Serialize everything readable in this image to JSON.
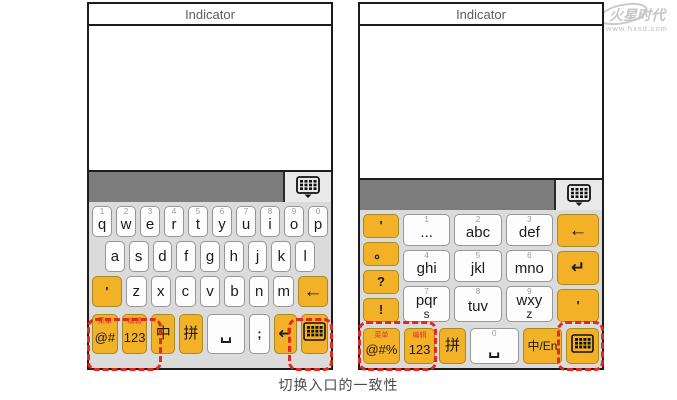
{
  "caption": "切换入口的一致性",
  "watermark": {
    "brand": "火星时代",
    "url": "www.hxsd.com"
  },
  "colors": {
    "key_yellow": "#F2B127",
    "highlight_red": "#E6281C",
    "toolbar_gray": "#7C7C7C",
    "keyboard_bg": "#DBDBDB",
    "hint_red": "#D93A26"
  },
  "left_phone": {
    "title": "Indicator",
    "toolbar_icon": "keyboard-panel-icon",
    "keyboard": {
      "row1": [
        {
          "s": "1",
          "m": "q"
        },
        {
          "s": "2",
          "m": "w"
        },
        {
          "s": "3",
          "m": "e"
        },
        {
          "s": "4",
          "m": "r"
        },
        {
          "s": "5",
          "m": "t"
        },
        {
          "s": "6",
          "m": "y"
        },
        {
          "s": "7",
          "m": "u"
        },
        {
          "s": "8",
          "m": "i"
        },
        {
          "s": "9",
          "m": "o"
        },
        {
          "s": "0",
          "m": "p"
        }
      ],
      "row2": [
        {
          "m": "a"
        },
        {
          "m": "s"
        },
        {
          "m": "d"
        },
        {
          "m": "f"
        },
        {
          "m": "g"
        },
        {
          "m": "h"
        },
        {
          "m": "j"
        },
        {
          "m": "k"
        },
        {
          "m": "l"
        }
      ],
      "row3": [
        {
          "m": "'",
          "c": "y",
          "w": "1.5",
          "n": "apostrophe",
          "cls": "cell-small"
        },
        {
          "m": "z"
        },
        {
          "m": "x"
        },
        {
          "m": "c"
        },
        {
          "m": "v"
        },
        {
          "m": "b"
        },
        {
          "m": "n"
        },
        {
          "m": "m"
        },
        {
          "m": "←",
          "c": "y",
          "w": "1.5",
          "n": "backspace",
          "icon": "backspace"
        }
      ],
      "row4": [
        {
          "t": "菜单",
          "m": "@#",
          "c": "y",
          "w": "1.1",
          "n": "symbols-switch"
        },
        {
          "t": "编辑",
          "m": "123",
          "c": "y",
          "w": "1.1",
          "n": "numbers-switch"
        },
        {
          "m": "中",
          "c": "y",
          "w": "1",
          "n": "chinese-mode"
        },
        {
          "m": "拼",
          "c": "y",
          "w": "1",
          "n": "pinyin-mode"
        },
        {
          "m": "␣",
          "w": "1.7",
          "n": "space",
          "icon": "space"
        },
        {
          "m": ";",
          "w": "0.85",
          "n": "punctuation",
          "cls": "cell-small"
        },
        {
          "m": "↵",
          "c": "y",
          "w": "1",
          "n": "enter",
          "icon": "enter"
        },
        {
          "c": "y",
          "w": "1.15",
          "n": "keyboard-switch",
          "icon": "kbgrid"
        }
      ]
    }
  },
  "right_phone": {
    "title": "Indicator",
    "toolbar_icon": "keyboard-panel-icon",
    "keyboard": {
      "punct_col": [
        {
          "m": "'",
          "c": "y",
          "n": "apostrophe"
        },
        {
          "m": "。",
          "c": "y",
          "n": "full-stop"
        },
        {
          "m": "?",
          "c": "y",
          "n": "question-mark"
        },
        {
          "m": "!",
          "c": "y",
          "n": "exclamation-mark"
        }
      ],
      "grid": [
        {
          "s": "1",
          "m": "..."
        },
        {
          "s": "2",
          "m": "abc"
        },
        {
          "s": "3",
          "m": "def"
        },
        {
          "s": "4",
          "m": "ghi"
        },
        {
          "s": "5",
          "m": "jkl"
        },
        {
          "s": "6",
          "m": "mno"
        },
        {
          "s": "7",
          "m": "pqr",
          "m2": "s"
        },
        {
          "s": "8",
          "m": "tuv"
        },
        {
          "s": "9",
          "m": "wxy",
          "m2": "z"
        }
      ],
      "right_col": [
        {
          "m": "←",
          "c": "y",
          "n": "backspace",
          "icon": "backspace"
        },
        {
          "m": "↵",
          "c": "y",
          "n": "enter",
          "icon": "enter"
        },
        {
          "m": "'",
          "c": "y",
          "n": "apostrophe",
          "cls": "cell-small"
        }
      ],
      "bottom": [
        {
          "t": "菜单",
          "m": "@#%",
          "c": "y",
          "w": "1.2",
          "n": "symbols-switch"
        },
        {
          "t": "编辑",
          "m": "123",
          "c": "y",
          "w": "1",
          "n": "numbers-switch"
        },
        {
          "m": "拼",
          "c": "y",
          "w": "0.85",
          "n": "pinyin-mode"
        },
        {
          "s": "0",
          "m": "␣",
          "w": "1.6",
          "n": "space",
          "icon": "space"
        },
        {
          "m": "中/En",
          "c": "y",
          "w": "1.3",
          "n": "lang-toggle",
          "cls": "lang"
        },
        {
          "c": "y",
          "w": "1.05",
          "n": "keyboard-switch",
          "icon": "kbgrid"
        }
      ]
    }
  }
}
